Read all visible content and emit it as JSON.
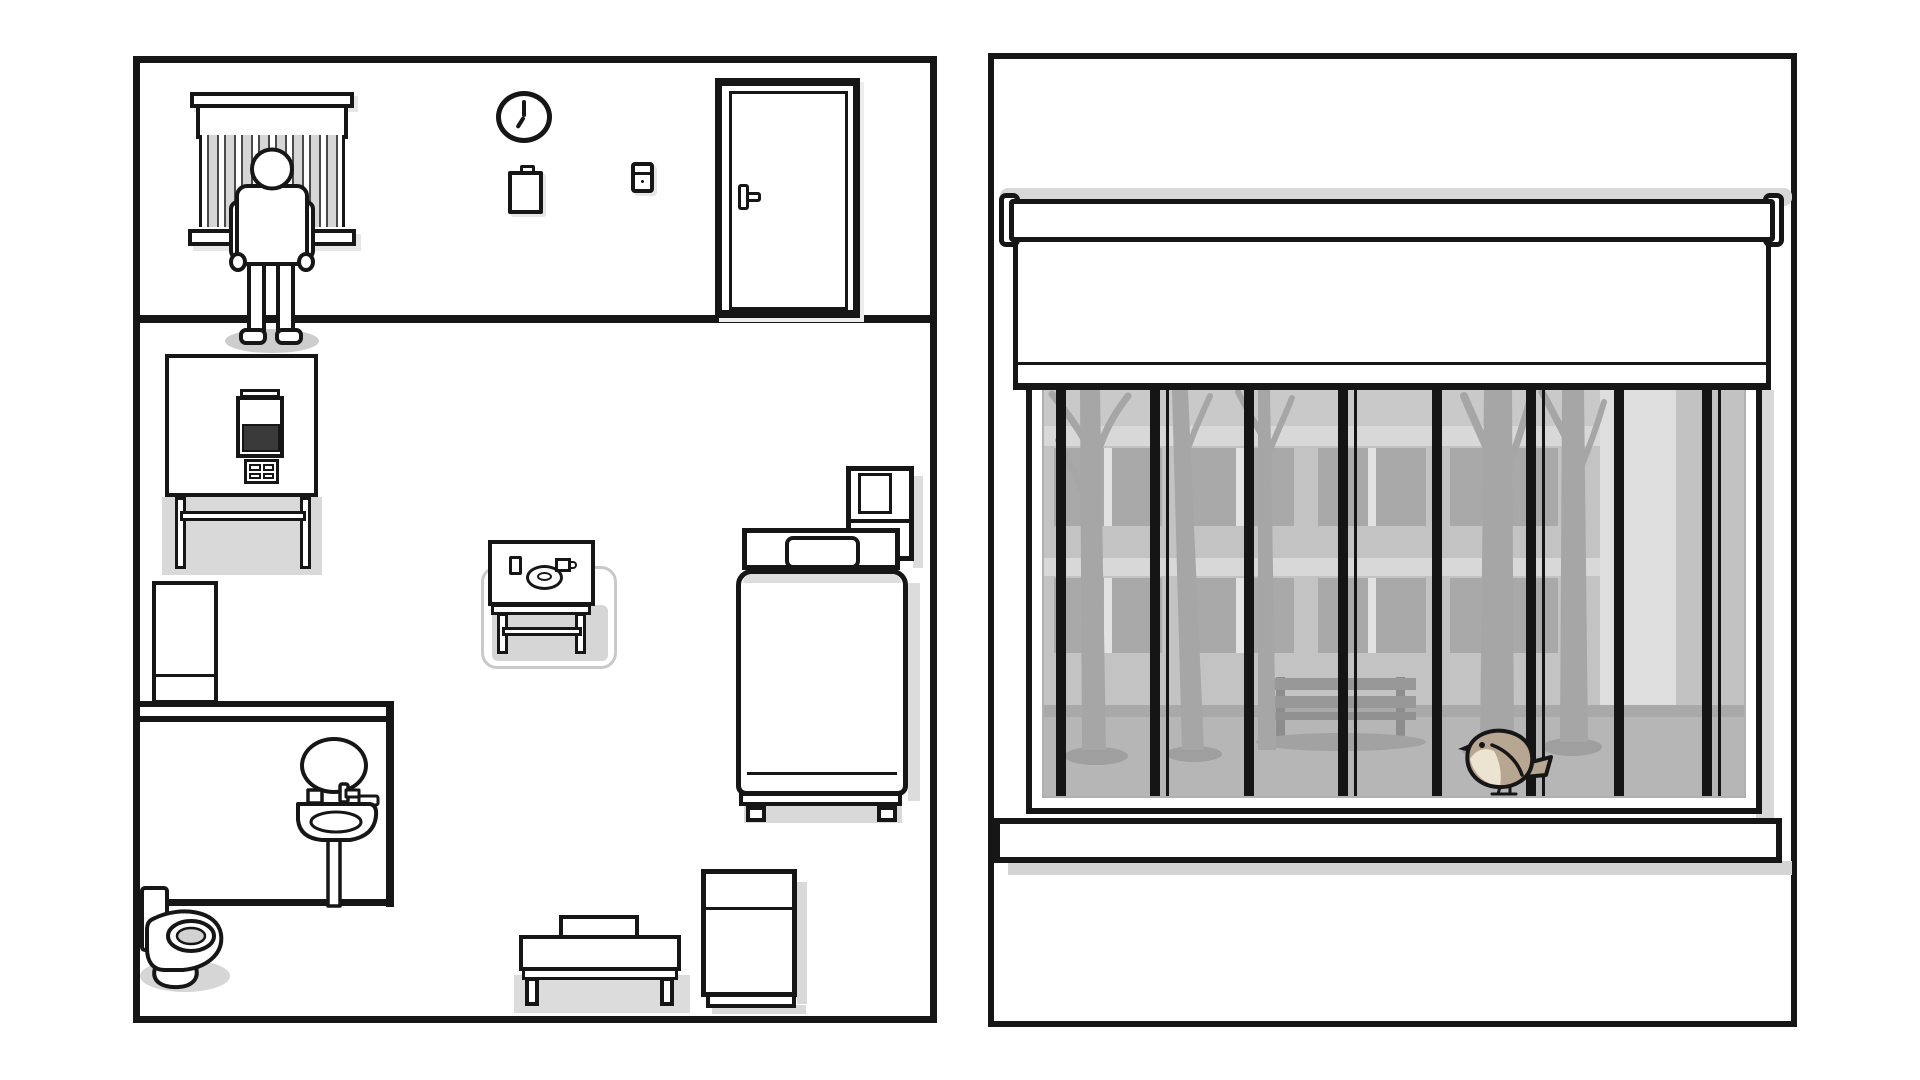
{
  "scene": {
    "style": "monochrome hand-drawn point-and-click adventure",
    "left_panel_label": "patient room, top-down cutaway view",
    "right_panel_label": "large window with roller blind and view outside"
  },
  "palette": {
    "ink": "#161616",
    "paper": "#ffffff",
    "object_shadow": "#d9d9d9",
    "window_bar_stripe": "#d6d6d6",
    "device_screen": "#3a3a3a",
    "glass_background": "#c9c9c9",
    "building_facade": "#c3c3c3",
    "building_window": "#a9a9a9",
    "building_band": "#d8d8d8",
    "side_strip_light": "#dedede",
    "side_strip_mid": "#c2c2c2",
    "ground": "#b6b6b6",
    "tree": "#a6a6a6",
    "bench_outside": "#989898",
    "bird_body": "#b7a691",
    "bird_breast": "#ece4d0"
  },
  "room": {
    "barred_window": {
      "label": "Barred window with valance and sill",
      "bars": 8
    },
    "patient": {
      "label": "Figure standing at the window",
      "pose": "standing, back to room"
    },
    "wall_clock": {
      "label": "Wall clock",
      "time": "7:00"
    },
    "clipboard": {
      "label": "Clipboard on wall"
    },
    "light_switch": {
      "label": "Light switch",
      "state": "off"
    },
    "door": {
      "label": "Room door",
      "state": "closed"
    },
    "food_machine": {
      "label": "Food machine on table",
      "screen": "dark",
      "buttons": 4
    },
    "locker": {
      "label": "Tall locker"
    },
    "bathroom": {
      "mirror": {
        "label": "Oval mirror"
      },
      "sink": {
        "label": "Pedestal sink with taps"
      },
      "toilet": {
        "label": "Toilet with tank"
      }
    },
    "meal_table": {
      "label": "Highlighted meal table",
      "items": [
        "glass",
        "plate",
        "mug"
      ]
    },
    "bed": {
      "label": "Bed with pillow and blanket"
    },
    "tv_stand": {
      "label": "TV on stand beside bed",
      "screen": "off"
    },
    "bench_box": {
      "label": "Low bench with folded box"
    },
    "nightstand": {
      "label": "Cabinet nightstand"
    }
  },
  "window_view": {
    "roller_blind": {
      "label": "Roller blind",
      "position": "lowered one third"
    },
    "bars_count": 8,
    "sill": {
      "label": "Window sill"
    },
    "outside": {
      "building": {
        "window_rows": 2,
        "windows_per_row": 8
      },
      "trees": 5,
      "bench": {
        "label": "Park bench"
      },
      "bird": {
        "label": "Small bird perched on sill",
        "body_color": "#b7a691",
        "breast_color": "#ece4d0"
      }
    }
  }
}
